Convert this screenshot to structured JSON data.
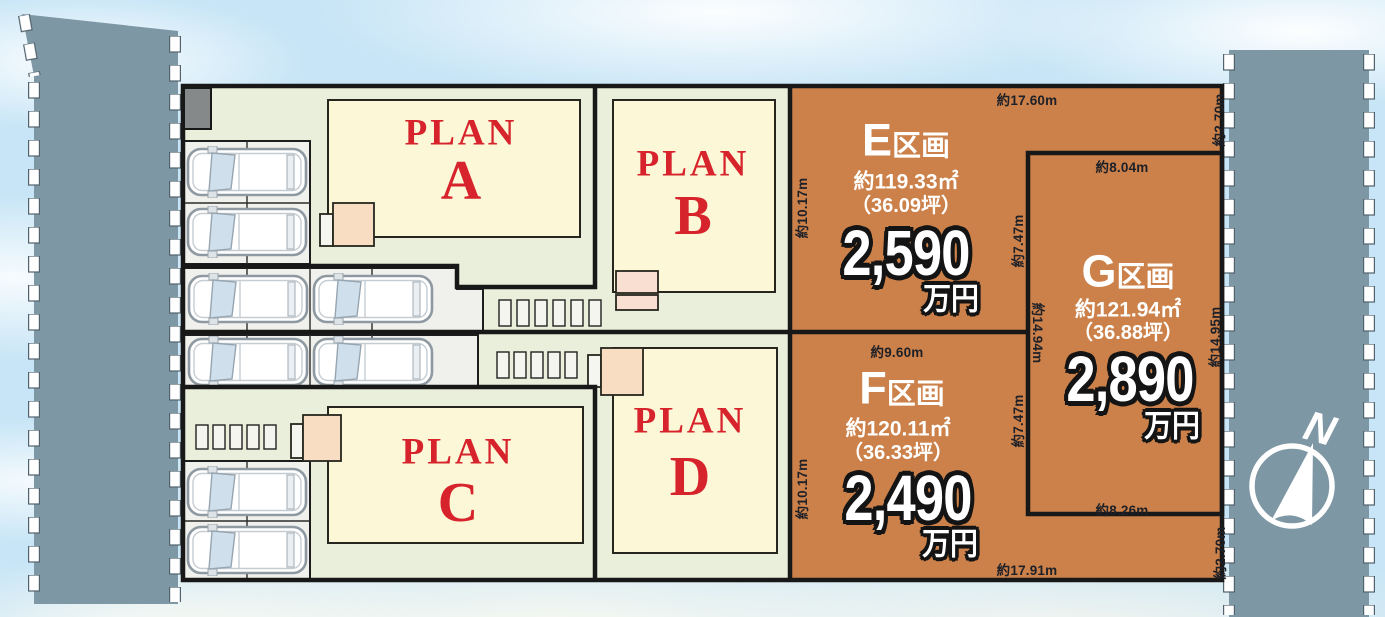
{
  "plots": {
    "E": {
      "name_letter": "E",
      "name_suffix": "区画",
      "area_m2": "約119.33㎡",
      "area_tsubo": "（36.09坪）",
      "price_amount": "2,590",
      "price_unit": "万円",
      "dims": {
        "top": "約17.60m",
        "right": "約2.70m",
        "left": "約10.17m",
        "side_g": "約7.47m"
      }
    },
    "F": {
      "name_letter": "F",
      "name_suffix": "区画",
      "area_m2": "約120.11㎡",
      "area_tsubo": "（36.33坪）",
      "price_amount": "2,490",
      "price_unit": "万円",
      "dims": {
        "top": "約9.60m",
        "left": "約10.17m",
        "side_g": "約7.47m",
        "bottom": "約17.91m",
        "bottom_right": "約2.70m"
      }
    },
    "G": {
      "name_letter": "G",
      "name_suffix": "区画",
      "area_m2": "約121.94㎡",
      "area_tsubo": "（36.88坪）",
      "price_amount": "2,890",
      "price_unit": "万円",
      "dims": {
        "top": "約8.04m",
        "left": "約14.94m",
        "right": "約14.95m",
        "bottom": "約8.26m"
      }
    }
  },
  "buildings": {
    "A": {
      "word": "PLAN",
      "letter": "A"
    },
    "B": {
      "word": "PLAN",
      "letter": "B"
    },
    "C": {
      "word": "PLAN",
      "letter": "C"
    },
    "D": {
      "word": "PLAN",
      "letter": "D"
    }
  },
  "compass": {
    "north_label": "N"
  },
  "colors": {
    "plot_orange": "#cb8149",
    "site_green": "#e9efda",
    "road_gray_blue": "#7e97a4",
    "plan_red": "#d7232b",
    "building_cream": "#fcf7d7",
    "porch_peach": "#f9ddc2",
    "boundary_black": "#181818",
    "price_text": "#ffffff"
  }
}
